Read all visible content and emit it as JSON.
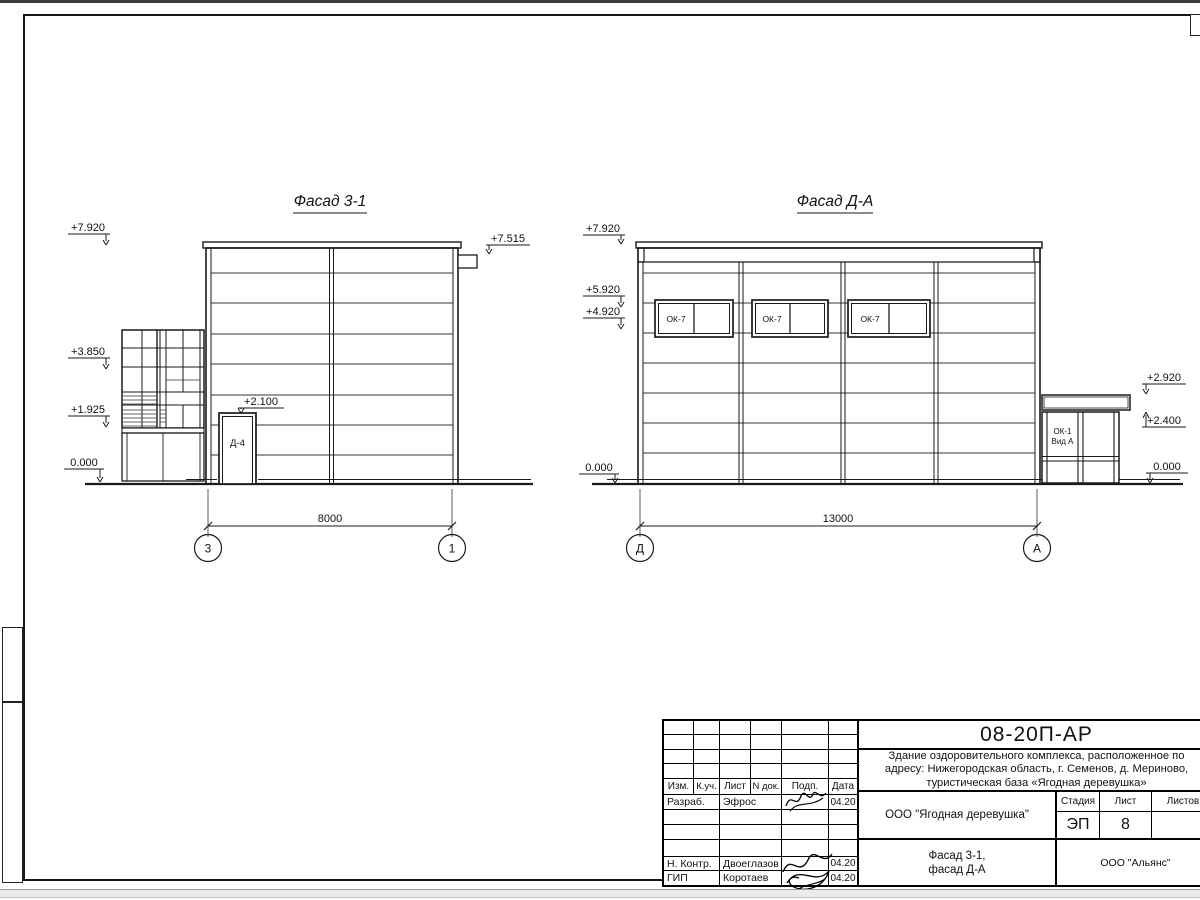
{
  "facade1": {
    "title": "Фасад 3-1",
    "elev_top": "+7.920",
    "elev_mid": "+3.850",
    "elev_low": "+1.925",
    "elev_zero": "0.000",
    "elev_scupper": "+7.515",
    "elev_door": "+2.100",
    "door_label": "Д-4",
    "dim": "8000",
    "axis_left": "3",
    "axis_right": "1"
  },
  "facade2": {
    "title": "Фасад Д-А",
    "elev_top": "+7.920",
    "elev_59": "+5.920",
    "elev_49": "+4.920",
    "elev_zero_left": "0.000",
    "elev_292": "+2.920",
    "elev_240": "+2.400",
    "elev_zero_right": "0.000",
    "window_label": "ОК-7",
    "annex_line1": "ОК-1",
    "annex_line2": "Вид А",
    "dim": "13000",
    "axis_left": "Д",
    "axis_right": "А"
  },
  "title_block": {
    "doc_number": "08-20П-АР",
    "desc1": "Здание оздоровительного комплекса, расположенное по",
    "desc2": "адресу: Нижегородская область, г. Семенов, д. Мериново,",
    "desc3": "туристическая база «Ягодная деревушка»",
    "client": "ООО \"Ягодная деревушка\"",
    "stage_label": "Стадия",
    "sheet_label": "Лист",
    "sheets_label": "Листов",
    "stage": "ЭП",
    "sheet_no": "8",
    "title1": "Фасад 3-1,",
    "title2": "фасад Д-А",
    "company": "ООО \"Альянс\"",
    "cols": [
      "Изм.",
      "К.уч.",
      "Лист",
      "N док.",
      "Подп.",
      "Дата"
    ],
    "rows": [
      {
        "role": "Разраб.",
        "name": "Эфрос",
        "date": "04.20"
      },
      {
        "role": "Н. Контр.",
        "name": "Двоеглазов",
        "date": "04.20"
      },
      {
        "role": "ГИП",
        "name": "Коротаев",
        "date": "04.20"
      }
    ]
  }
}
